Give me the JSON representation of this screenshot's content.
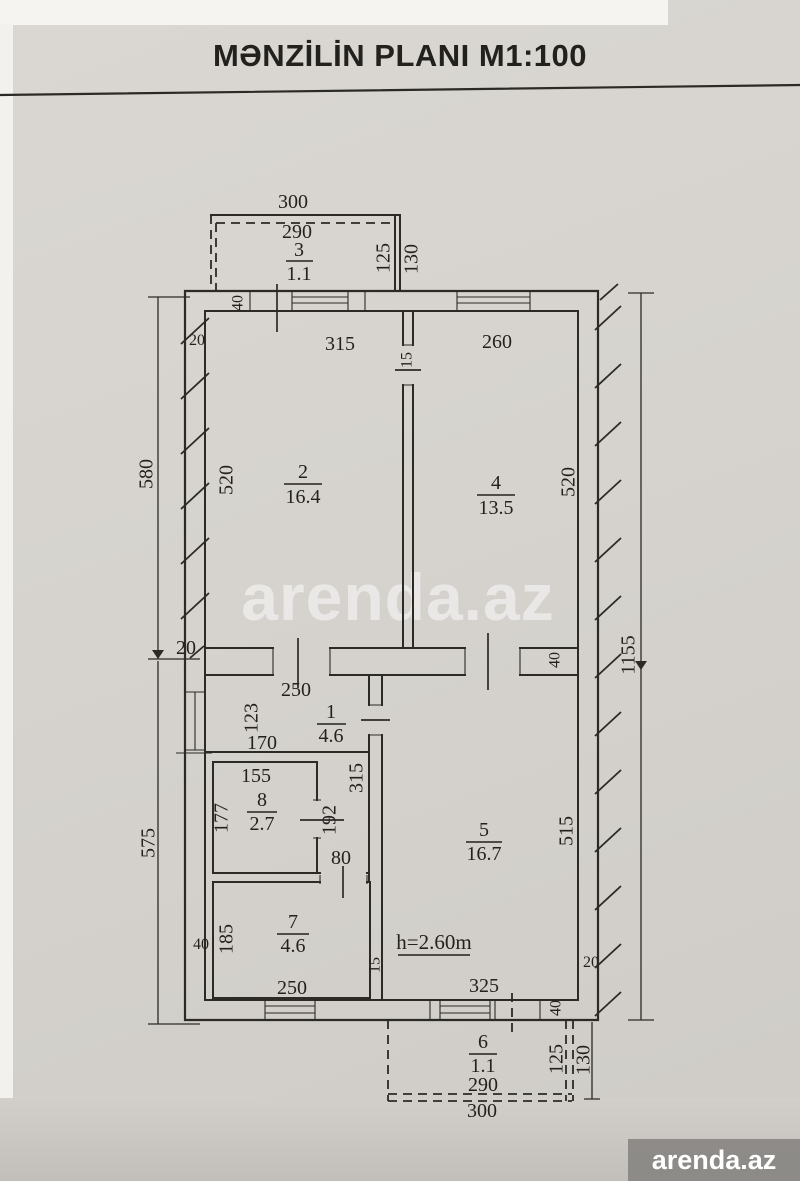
{
  "title": "MƏNZİLİN PLANI M1:100",
  "watermark": {
    "center_text": "arenda.az",
    "badge_text": "arenda.az"
  },
  "plan": {
    "height_note": "h=2.60m",
    "rooms": [
      {
        "number": "3",
        "area": "1.1"
      },
      {
        "number": "2",
        "area": "16.4"
      },
      {
        "number": "4",
        "area": "13.5"
      },
      {
        "number": "1",
        "area": "4.6"
      },
      {
        "number": "8",
        "area": "2.7"
      },
      {
        "number": "5",
        "area": "16.7"
      },
      {
        "number": "7",
        "area": "4.6"
      },
      {
        "number": "6",
        "area": "1.1"
      }
    ],
    "dims": {
      "balcony_top_outer_width": "300",
      "balcony_top_inner_width": "290",
      "balcony_top_inner_depth": "125",
      "balcony_top_outer_depth": "130",
      "wall_top_left_thickness": "40",
      "offset_top_left": "20",
      "door_rooms_2_4": "15",
      "room2_width": "315",
      "room2_height": "520",
      "room4_width": "260",
      "room4_height": "520",
      "left_upper_total": "580",
      "left_lower_total": "575",
      "right_total": "1155",
      "offset_mid_left": "20",
      "wall_mid_right_thickness": "40",
      "hall_width": "250",
      "hall_window": "123",
      "hall_bottom": "170",
      "room8_width": "155",
      "room8_height": "177",
      "room8_door": "192",
      "corridor_height": "315",
      "opening_80": "80",
      "room7_height": "185",
      "wall_left_room7": "40",
      "room7_width": "250",
      "wall_room5_left": "15",
      "room5_height": "515",
      "room5_width": "325",
      "offset_bottom_right": "20",
      "wall_bottom_thickness": "40",
      "balcony_bottom_inner_depth": "125",
      "balcony_bottom_outer_depth": "130",
      "balcony_bottom_inner_width": "290",
      "balcony_bottom_outer_width": "300"
    }
  }
}
